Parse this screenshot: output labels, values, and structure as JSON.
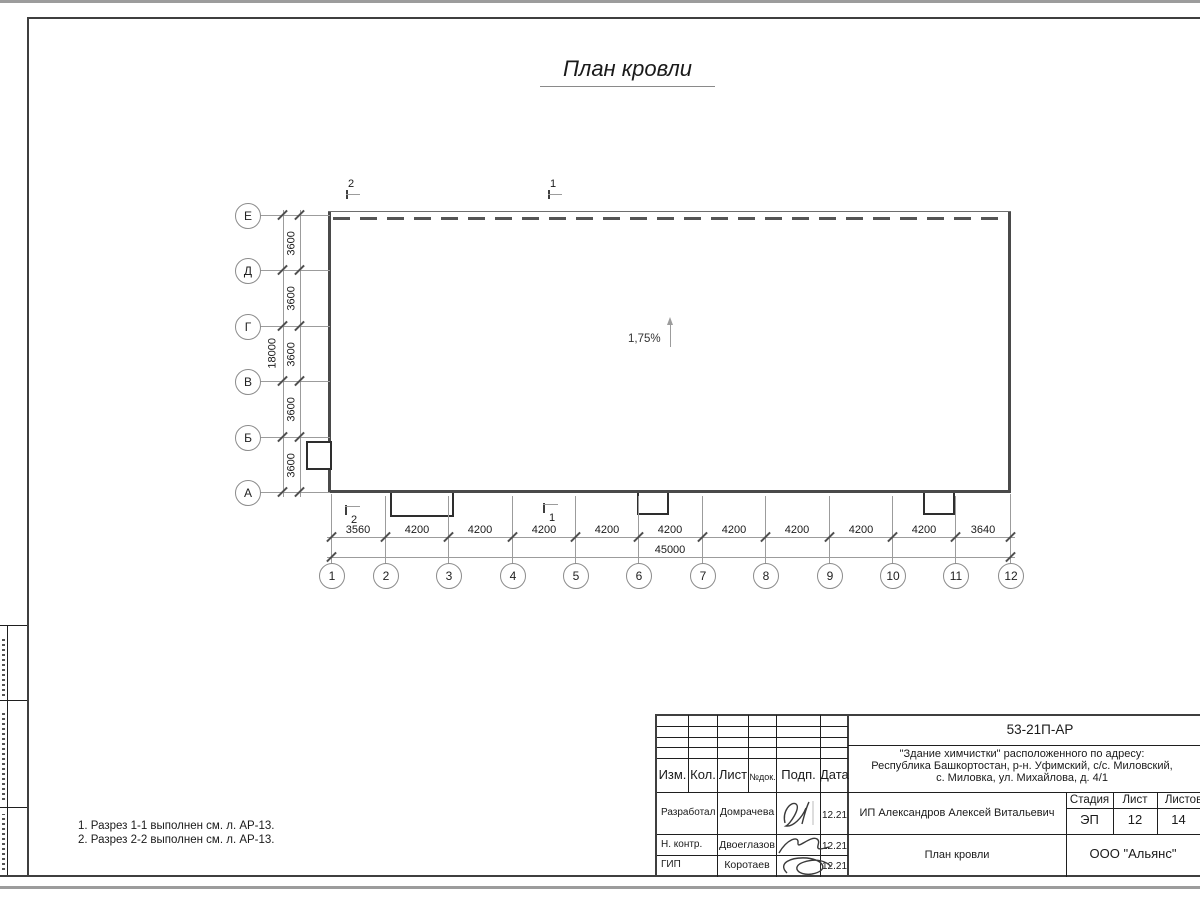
{
  "sheet_title": "План кровли",
  "plan": {
    "slope_label": "1,75%",
    "sections": {
      "left": "2",
      "right": "1"
    },
    "v_axes": {
      "labels": [
        "Е",
        "Д",
        "Г",
        "В",
        "Б",
        "А"
      ],
      "dims": [
        "3600",
        "3600",
        "3600",
        "3600",
        "3600"
      ],
      "total": "18000"
    },
    "h_axes": {
      "labels": [
        "1",
        "2",
        "3",
        "4",
        "5",
        "6",
        "7",
        "8",
        "9",
        "10",
        "11",
        "12"
      ],
      "dims": [
        "3560",
        "4200",
        "4200",
        "4200",
        "4200",
        "4200",
        "4200",
        "4200",
        "4200",
        "4200",
        "3640"
      ],
      "total": "45000"
    }
  },
  "notes": [
    "1. Разрез 1-1 выполнен см. л. АР-13.",
    "2. Разрез 2-2 выполнен см. л. АР-13."
  ],
  "title_block": {
    "doc_number": "53-21П-АР",
    "object_line1": "\"Здание химчистки\" расположенного по адресу:",
    "object_line2": "Республика Башкортостан, р-н. Уфимский, с/с. Миловский,",
    "object_line3": "с. Миловка, ул. Михайлова, д. 4/1",
    "columns": {
      "izm": "Изм.",
      "kol": "Кол.",
      "list": "Лист",
      "ndok": "№док.",
      "podp": "Подп.",
      "data": "Дата"
    },
    "staff": [
      {
        "role": "Разработал",
        "name": "Домрачева",
        "date": "12.21"
      },
      {
        "role": "Н. контр.",
        "name": "Двоеглазов",
        "date": "12.21"
      },
      {
        "role": "ГИП",
        "name": "Коротаев",
        "date": "12.21"
      }
    ],
    "client": "ИП Александров Алексей Витальевич",
    "stage_label": "Стадия",
    "sheet_label": "Лист",
    "sheets_label": "Листов",
    "stage": "ЭП",
    "sheet_num": "12",
    "sheets_total": "14",
    "drawing_name": "План кровли",
    "company": "ООО \"Альянс\""
  }
}
